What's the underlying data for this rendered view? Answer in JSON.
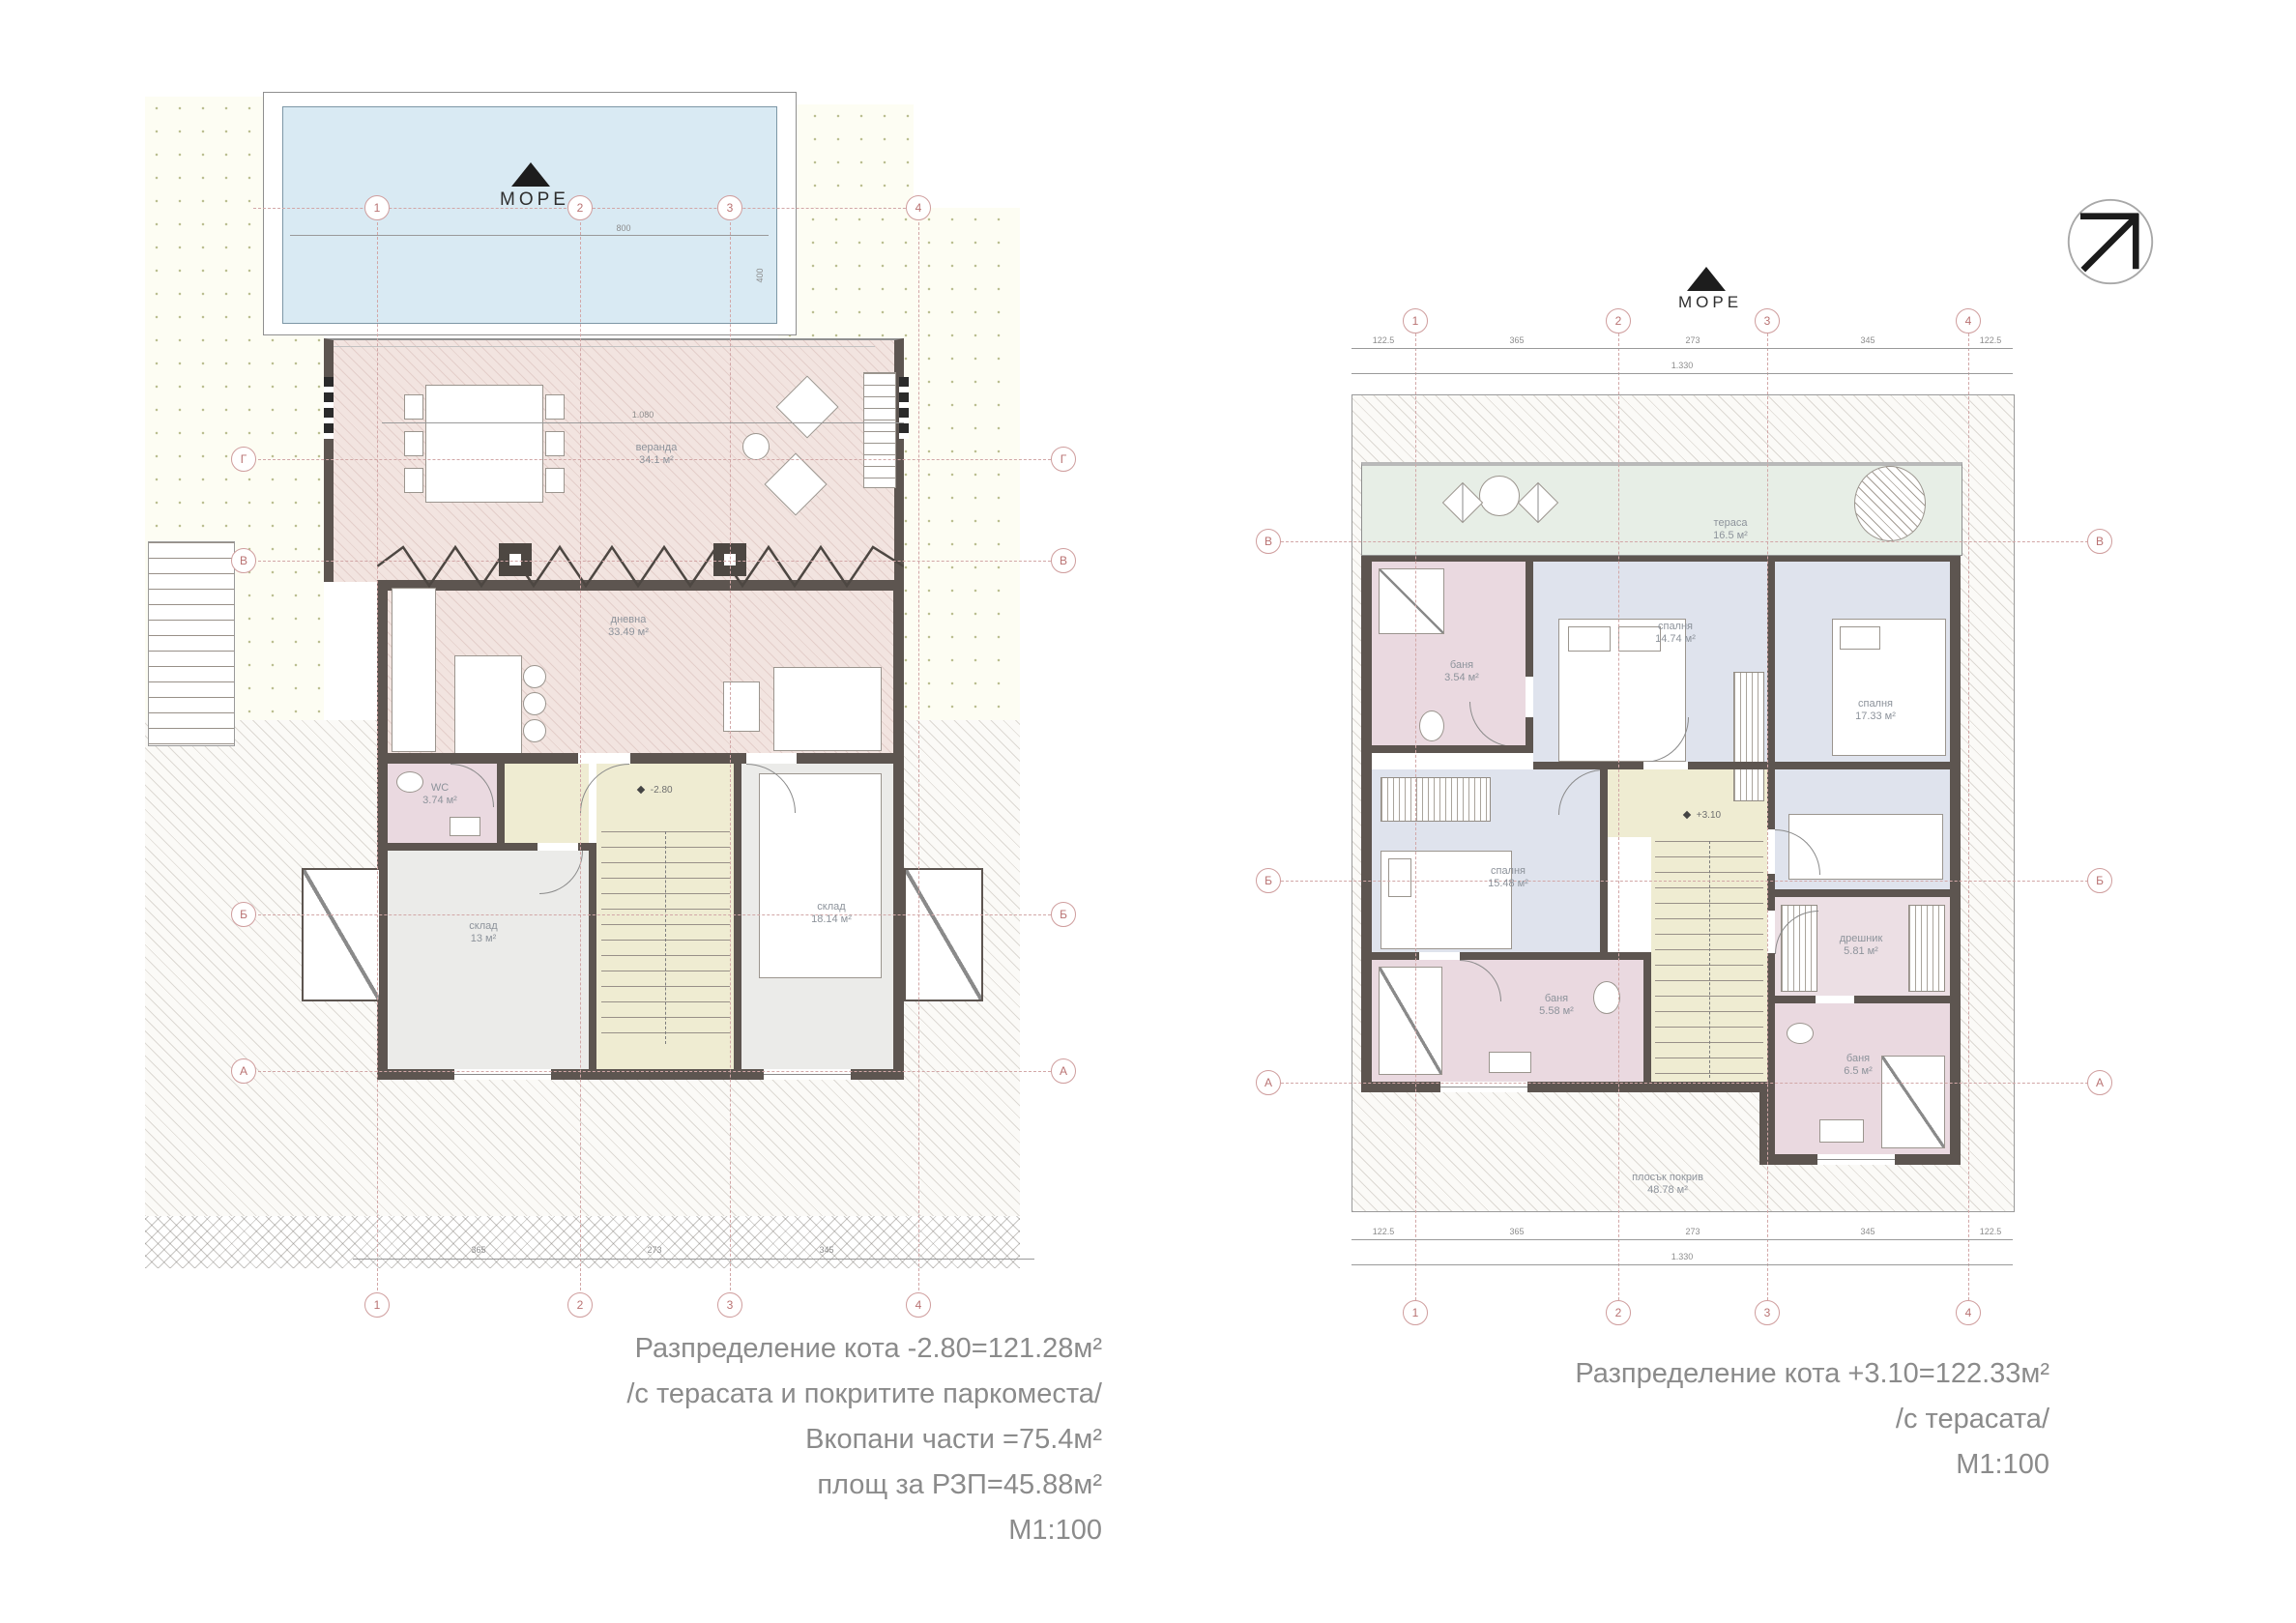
{
  "left_plan": {
    "sea_label": "МОРЕ",
    "grid": {
      "cols": [
        "1",
        "2",
        "3",
        "4"
      ],
      "rows": [
        "Г",
        "В",
        "Б",
        "А"
      ]
    },
    "rooms": {
      "terrace": {
        "name": "веранда",
        "area": "34.1 м²"
      },
      "living": {
        "name": "дневна",
        "area": "33.49 м²"
      },
      "wc": {
        "name": "WC",
        "area": "3.74 м²"
      },
      "storage_small": {
        "name": "склад",
        "area": "13 м²"
      },
      "storage_big": {
        "name": "склад",
        "area": "18.14 м²"
      }
    },
    "elevation_mark": "-2.80",
    "dims": {
      "pool_width": "800",
      "pool_height": "400",
      "terrace_width": "1.080",
      "bottom": [
        "365",
        "273",
        "345"
      ]
    },
    "caption": [
      "Разпределение кота -2.80=121.28м²",
      "/с терасата и покритите паркоместа/",
      "Вкопани части =75.4м²",
      "площ за РЗП=45.88м²",
      "М1:100"
    ]
  },
  "right_plan": {
    "sea_label": "МОРЕ",
    "grid": {
      "cols": [
        "1",
        "2",
        "3",
        "4"
      ],
      "rows": [
        "В",
        "Б",
        "А"
      ]
    },
    "rooms": {
      "terrace": {
        "name": "тераса",
        "area": "16.5 м²"
      },
      "bath_top": {
        "name": "баня",
        "area": "3.54 м²"
      },
      "bedroom_center": {
        "name": "спалня",
        "area": "14.74 м²"
      },
      "bedroom_right": {
        "name": "спалня",
        "area": "17.33 м²"
      },
      "bedroom_left": {
        "name": "спалня",
        "area": "15.48 м²"
      },
      "bath_left": {
        "name": "баня",
        "area": "5.58 м²"
      },
      "wardrobe": {
        "name": "дрешник",
        "area": "5.81 м²"
      },
      "bath_right": {
        "name": "баня",
        "area": "6.5 м²"
      },
      "flat_roof": {
        "name": "плосък покрив",
        "area": "48.78 м²"
      }
    },
    "elevation_mark": "+3.10",
    "dims": {
      "top": [
        "122.5",
        "365",
        "273",
        "345",
        "122.5"
      ],
      "top_total": "1.330",
      "bottom": [
        "122.5",
        "365",
        "273",
        "345",
        "122.5"
      ],
      "bottom_total": "1.330"
    },
    "caption": [
      "Разпределение кота +3.10=122.33м²",
      "/с терасата/",
      "М1:100"
    ]
  }
}
